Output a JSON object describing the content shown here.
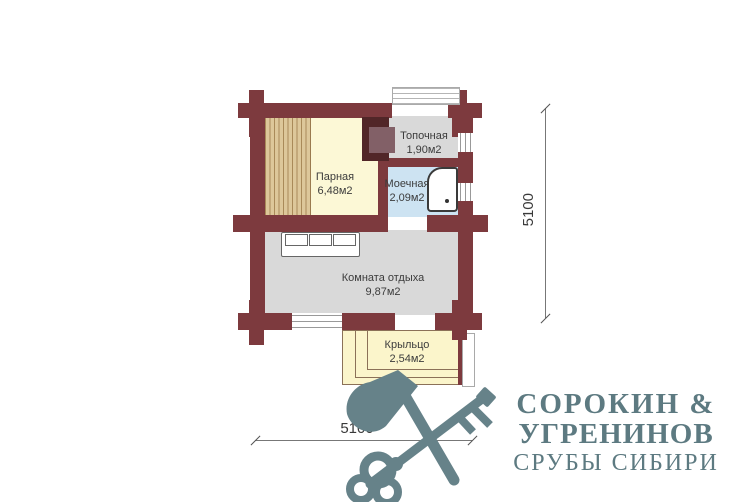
{
  "plan": {
    "rooms": {
      "parnaya": {
        "name": "Парная",
        "area": "6,48м2"
      },
      "topochnaya": {
        "name": "Топочная",
        "area": "1,90м2"
      },
      "moechnaya": {
        "name": "Моечная",
        "area": "2,09м2"
      },
      "komnata_otdyha": {
        "name": "Комната отдыха",
        "area": "9,87м2"
      },
      "kryltso": {
        "name": "Крыльцо",
        "area": "2,54м2"
      }
    },
    "dimensions": {
      "right": "5100",
      "bottom": "5100"
    },
    "colors": {
      "wall": "#7d3a3e",
      "parnaya_floor": "#fcf8d6",
      "bench": "#ddc79a",
      "gray_floor": "#d9d9d9",
      "moechnaya_floor": "#cde3f2",
      "porch_floor": "#fbf5cb",
      "stove": "#512628",
      "logo": "#5d7a81"
    }
  },
  "logo": {
    "line1": "СОРОКИН &",
    "line2": "УГРЕНИНОВ",
    "line3": "СРУБЫ СИБИРИ"
  }
}
